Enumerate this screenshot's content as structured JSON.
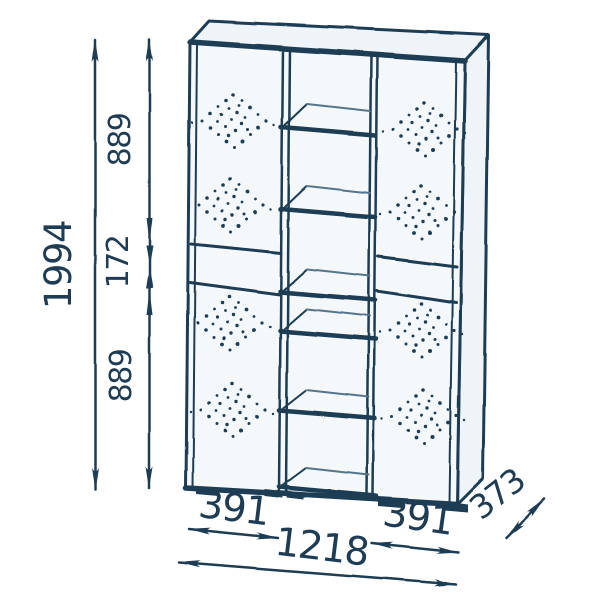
{
  "dimensions": {
    "total_height": "1994",
    "top_section_height": "889",
    "middle_section_height": "172",
    "bottom_section_height": "889",
    "left_door_width": "391",
    "right_door_width": "391",
    "total_width": "1218",
    "depth": "373"
  },
  "colors": {
    "line": "#1e3c53",
    "line_light": "#54748a",
    "panel": "#f4f8fb",
    "panel_top": "#eef4f8",
    "background": "#ffffff"
  }
}
